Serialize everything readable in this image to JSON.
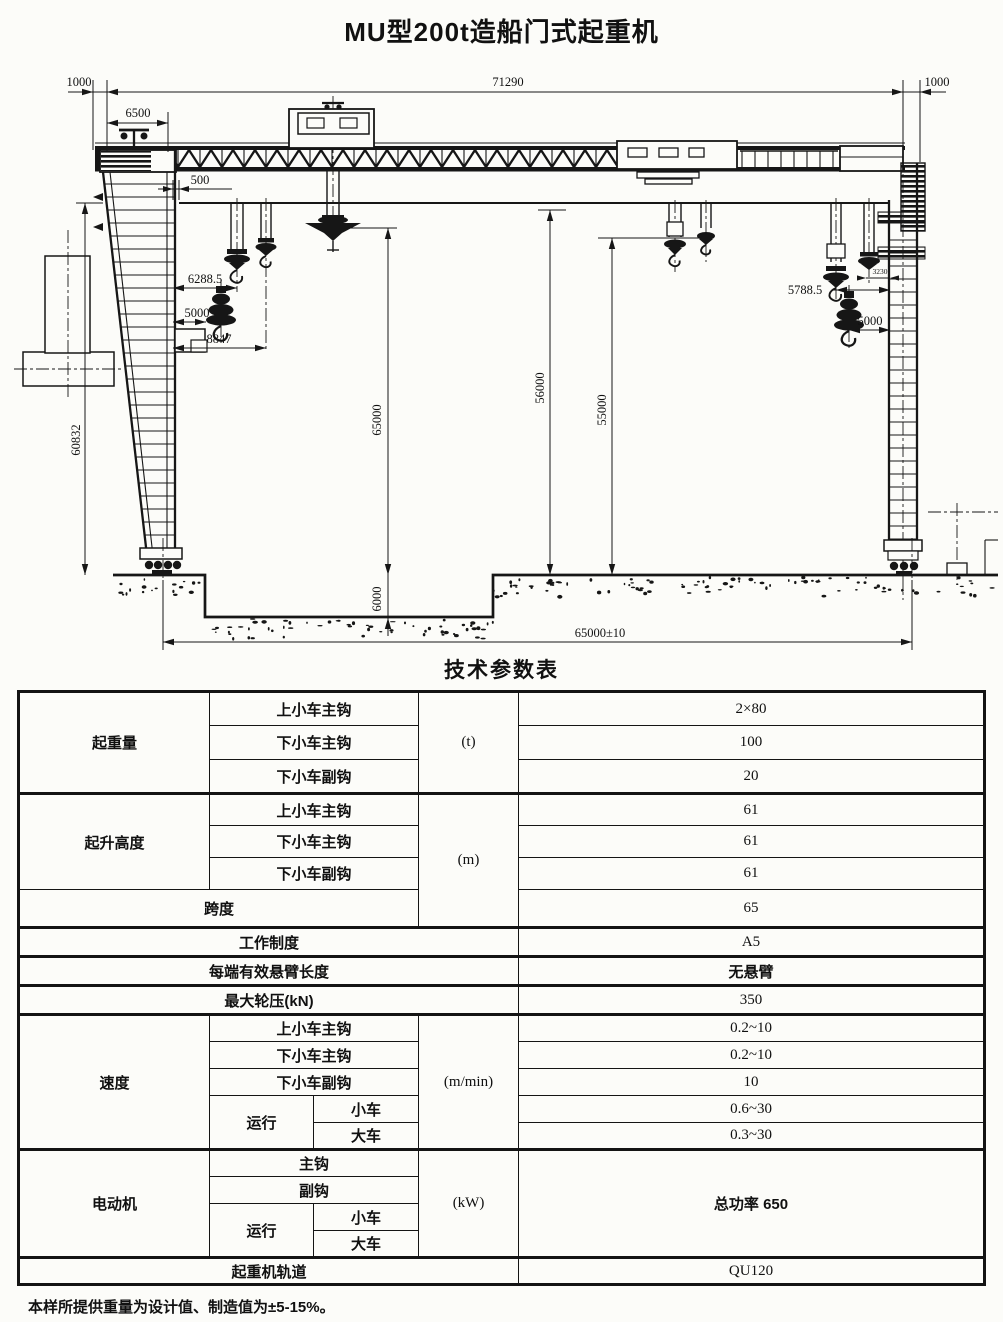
{
  "title": "MU型200t造船门式起重机",
  "drawing": {
    "dims": {
      "total_length": "71290",
      "left_overhang": "1000",
      "right_overhang": "1000",
      "upper_trolley_offset": "6500",
      "rail_clearance": "500",
      "lower_main_hook_approach": "6288.5",
      "lower_block_approach": "5000",
      "lower_aux_hook_approach": "8847",
      "leg_height": "60832",
      "hook_lift_height": "65000",
      "pit_depth": "6000",
      "clearance_under_girder": "56000",
      "hook_clearance": "55000",
      "right_main_hook_approach": "5788.5",
      "right_hook_offset": "3230",
      "right_block_approach": "5000",
      "track_gauge": "65000±10"
    }
  },
  "table": {
    "heading": "技术参数表",
    "capacity": {
      "label": "起重量",
      "unit": "(t)",
      "rows": [
        {
          "name": "上小车主钩",
          "value": "2×80"
        },
        {
          "name": "下小车主钩",
          "value": "100"
        },
        {
          "name": "下小车副钩",
          "value": "20"
        }
      ]
    },
    "height": {
      "label": "起升高度",
      "unit": "(m)",
      "rows": [
        {
          "name": "上小车主钩",
          "value": "61"
        },
        {
          "name": "下小车主钩",
          "value": "61"
        },
        {
          "name": "下小车副钩",
          "value": "61"
        }
      ]
    },
    "span": {
      "label": "跨度",
      "value": "65"
    },
    "duty": {
      "label": "工作制度",
      "value": "A5"
    },
    "cantilever": {
      "label": "每端有效悬臂长度",
      "value": "无悬臂"
    },
    "max_wheel_load": {
      "label": "最大轮压(kN)",
      "value": "350"
    },
    "speed": {
      "label": "速度",
      "unit": "(m/min)",
      "rows": [
        {
          "name": "上小车主钩",
          "value": "0.2~10"
        },
        {
          "name": "下小车主钩",
          "value": "0.2~10"
        },
        {
          "name": "下小车副钩",
          "value": "10"
        }
      ],
      "travel_label": "运行",
      "travel_rows": [
        {
          "name": "小车",
          "value": "0.6~30"
        },
        {
          "name": "大车",
          "value": "0.3~30"
        }
      ]
    },
    "motor": {
      "label": "电动机",
      "unit": "(kW)",
      "value": "总功率 650",
      "rows": [
        {
          "name": "主钩"
        },
        {
          "name": "副钩"
        }
      ],
      "travel_label": "运行",
      "travel_rows": [
        {
          "name": "小车"
        },
        {
          "name": "大车"
        }
      ]
    },
    "rail": {
      "label": "起重机轨道",
      "value": "QU120"
    }
  },
  "footnote": "本样所提供重量为设计值、制造值为±5-15%。"
}
